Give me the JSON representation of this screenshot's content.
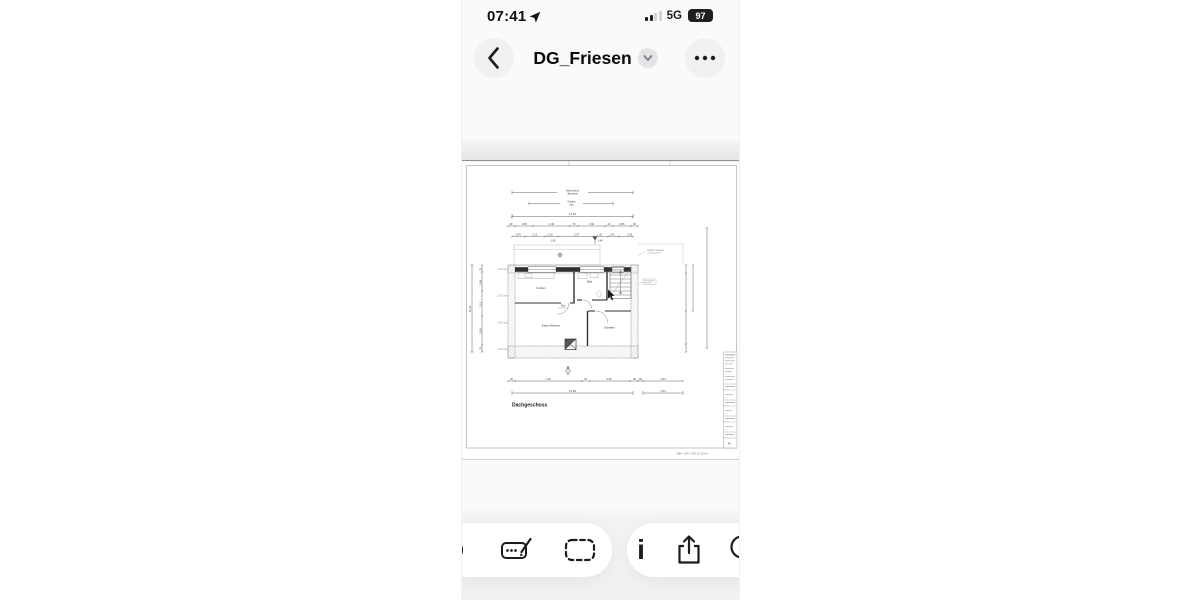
{
  "colors": {
    "icon_dark": "#1c1c1e",
    "phone_bg": "#fafafa",
    "toolbar_bg": "#f1f1f2",
    "pill_bg": "#ffffff",
    "battery_badge": "#1f1f21"
  },
  "status_bar": {
    "time": "07:41",
    "network": "5G",
    "battery_percent": "97"
  },
  "navigation": {
    "title": "DG_Friesen"
  },
  "plan": {
    "drawing_label": "Dachgeschoss",
    "paper_note": "MB = 297 / 420 (0.12m²)",
    "title_block_note": "M",
    "annotation_right": "Auffahrt Garage",
    "spans": {
      "outer_line1": "Wohnhaus",
      "outer_line2": "Bestand",
      "inner_line1": "Gaube",
      "inner_line2": "neu"
    },
    "rooms": {
      "kitchen": "Kochen",
      "bath": "Bad",
      "hall": "Flur",
      "living": "Essen Wohnen",
      "bedroom": "Schlafen"
    },
    "roof_lines": {
      "l1": "1.00 Linie",
      "l2": "2.00 Linie",
      "l3": "2.00 Linie",
      "l4": "1.00 Linie"
    },
    "dims": {
      "overall_top": "12.48",
      "overall_bottom": "12.48",
      "chain_top_1": [
        "30",
        "1.98",
        "4.30",
        "70",
        "3.90",
        "24",
        "2.86",
        "30"
      ],
      "chain_top_2": [
        "1.64",
        "1.13",
        "2.20",
        "2.27",
        "1.20",
        "1.42",
        "2.36"
      ],
      "chain_top_sub": [
        "1.90",
        "1.40"
      ],
      "chain_bottom": [
        "30",
        "7.16",
        "70",
        "4.30",
        "30"
      ],
      "right_ext": [
        "30",
        "4.54"
      ],
      "right_ext_total": "4.54",
      "left_overall": "10.11",
      "left_chain": [
        "73",
        "2.84",
        "2.13",
        "2.84",
        "73"
      ]
    }
  },
  "toolbar": {
    "info_glyph": "i",
    "icons": [
      "clipped-circle",
      "markup",
      "select-area",
      "info",
      "share",
      "search"
    ]
  }
}
